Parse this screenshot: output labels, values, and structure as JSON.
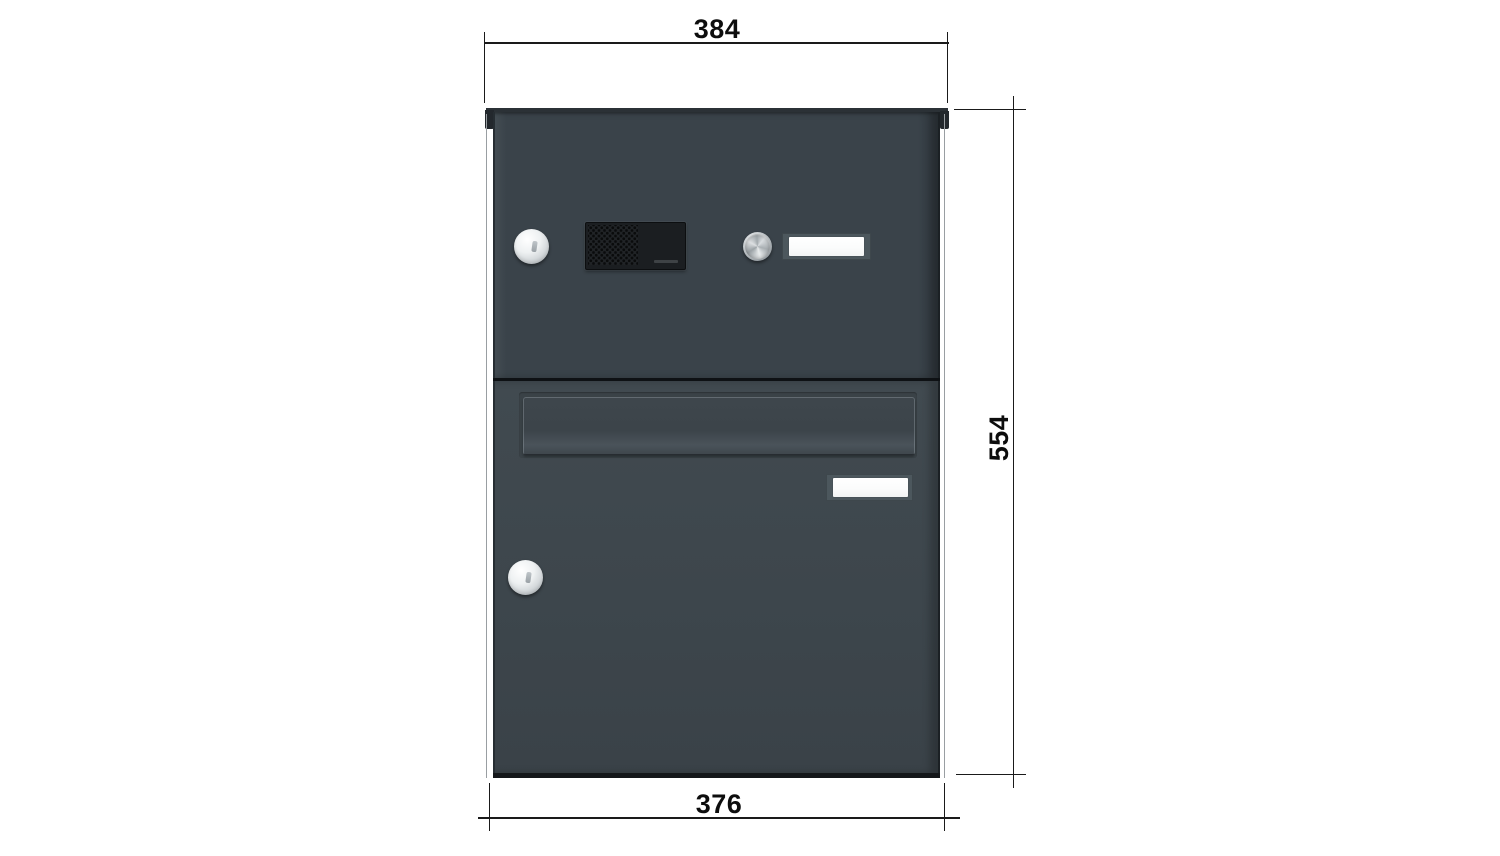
{
  "dimensions": {
    "top_width": "384",
    "height": "554",
    "bottom_width": "376"
  },
  "colors": {
    "background": "#ffffff",
    "dimension_line": "#1a1a1a",
    "body_anthracite": "#3a434a",
    "door_anthracite": "#3d464c",
    "edge_dark": "#14171a",
    "intercom_black": "#1b1e21",
    "nameplate_frame": "#4c575d",
    "nameplate_card": "#fdfdfd",
    "steel_light": "#f4f6f7",
    "steel_dark": "#8c9398"
  },
  "components": {
    "upper_lock": "lock-cylinder-icon",
    "intercom": "speaker-grille-icon",
    "bell_button": "doorbell-button-icon",
    "upper_nameplate": "name-plate",
    "mail_slot": "mail-slot-flap",
    "lower_nameplate": "name-plate",
    "lower_lock": "lock-cylinder-icon"
  }
}
